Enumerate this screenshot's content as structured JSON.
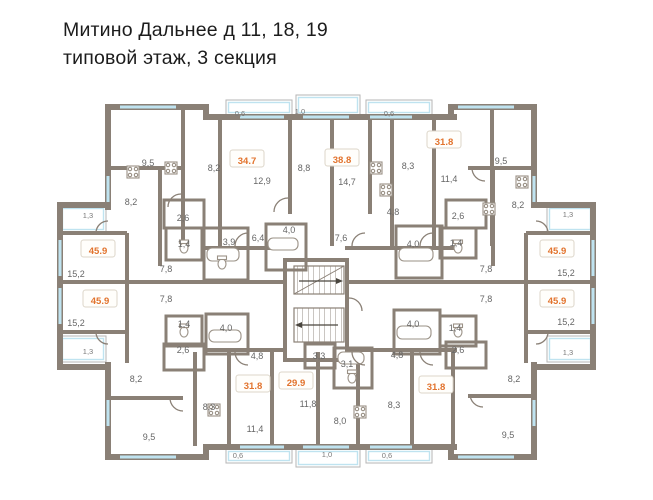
{
  "title": {
    "line1": "Митино Дальнее д 11, 18, 19",
    "line2": "типовой этаж, 3 секция"
  },
  "colors": {
    "wall": "#8a8076",
    "window": "#bfe3f0",
    "accent": "#e2732d",
    "room_label": "#666666",
    "dim_label": "#7a7a7a",
    "title_text": "#1c1c1c"
  },
  "plan": {
    "apartments": [
      {
        "area": "34.7",
        "x": 247,
        "y": 162
      },
      {
        "area": "38.8",
        "x": 342,
        "y": 161
      },
      {
        "area": "31.8",
        "x": 444,
        "y": 143
      },
      {
        "area": "45.9",
        "x": 98,
        "y": 252
      },
      {
        "area": "45.9",
        "x": 100,
        "y": 302
      },
      {
        "area": "45.9",
        "x": 557,
        "y": 252
      },
      {
        "area": "45.9",
        "x": 557,
        "y": 302
      },
      {
        "area": "31.8",
        "x": 253,
        "y": 387
      },
      {
        "area": "29.9",
        "x": 296,
        "y": 384
      },
      {
        "area": "31.8",
        "x": 436,
        "y": 388
      }
    ],
    "rooms": [
      {
        "value": "9,5",
        "x": 148,
        "y": 163
      },
      {
        "value": "8,2",
        "x": 214,
        "y": 168
      },
      {
        "value": "12,9",
        "x": 262,
        "y": 181
      },
      {
        "value": "8,8",
        "x": 304,
        "y": 168
      },
      {
        "value": "14,7",
        "x": 347,
        "y": 182
      },
      {
        "value": "8,3",
        "x": 408,
        "y": 166
      },
      {
        "value": "11,4",
        "x": 449,
        "y": 179
      },
      {
        "value": "9,5",
        "x": 501,
        "y": 161
      },
      {
        "value": "8,2",
        "x": 131,
        "y": 202
      },
      {
        "value": "8,2",
        "x": 518,
        "y": 205
      },
      {
        "value": "2,6",
        "x": 183,
        "y": 218
      },
      {
        "value": "2,6",
        "x": 458,
        "y": 216
      },
      {
        "value": "1,4",
        "x": 184,
        "y": 244
      },
      {
        "value": "3,9",
        "x": 229,
        "y": 242
      },
      {
        "value": "4,0",
        "x": 289,
        "y": 230
      },
      {
        "value": "6,4",
        "x": 258,
        "y": 238
      },
      {
        "value": "7,6",
        "x": 341,
        "y": 238
      },
      {
        "value": "4,8",
        "x": 393,
        "y": 212
      },
      {
        "value": "4,0",
        "x": 413,
        "y": 244
      },
      {
        "value": "1,4",
        "x": 456,
        "y": 243
      },
      {
        "value": "7,8",
        "x": 166,
        "y": 269
      },
      {
        "value": "15,2",
        "x": 76,
        "y": 274
      },
      {
        "value": "7,8",
        "x": 486,
        "y": 269
      },
      {
        "value": "15,2",
        "x": 566,
        "y": 273
      },
      {
        "value": "7,8",
        "x": 166,
        "y": 299
      },
      {
        "value": "15,2",
        "x": 76,
        "y": 323
      },
      {
        "value": "7,8",
        "x": 486,
        "y": 299
      },
      {
        "value": "15,2",
        "x": 566,
        "y": 322
      },
      {
        "value": "1,4",
        "x": 184,
        "y": 324
      },
      {
        "value": "4,0",
        "x": 226,
        "y": 328
      },
      {
        "value": "4,0",
        "x": 413,
        "y": 324
      },
      {
        "value": "1,4",
        "x": 455,
        "y": 328
      },
      {
        "value": "2,6",
        "x": 183,
        "y": 350
      },
      {
        "value": "2,6",
        "x": 458,
        "y": 350
      },
      {
        "value": "4,8",
        "x": 257,
        "y": 356
      },
      {
        "value": "3,3",
        "x": 319,
        "y": 356
      },
      {
        "value": "3,1",
        "x": 347,
        "y": 364
      },
      {
        "value": "4,8",
        "x": 397,
        "y": 355
      },
      {
        "value": "8,2",
        "x": 136,
        "y": 379
      },
      {
        "value": "8,2",
        "x": 514,
        "y": 379
      },
      {
        "value": "8,3",
        "x": 209,
        "y": 407
      },
      {
        "value": "11,8",
        "x": 308,
        "y": 404
      },
      {
        "value": "8,0",
        "x": 340,
        "y": 421
      },
      {
        "value": "8,3",
        "x": 394,
        "y": 405
      },
      {
        "value": "11,4",
        "x": 255,
        "y": 429
      },
      {
        "value": "9,5",
        "x": 149,
        "y": 437
      },
      {
        "value": "9,5",
        "x": 508,
        "y": 435
      }
    ],
    "dimensions": [
      {
        "value": "0,6",
        "x": 240,
        "y": 113
      },
      {
        "value": "1,0",
        "x": 300,
        "y": 111
      },
      {
        "value": "0,6",
        "x": 389,
        "y": 113
      },
      {
        "value": "1,3",
        "x": 88,
        "y": 215
      },
      {
        "value": "1,3",
        "x": 568,
        "y": 214
      },
      {
        "value": "1,3",
        "x": 88,
        "y": 351
      },
      {
        "value": "1,3",
        "x": 568,
        "y": 352
      },
      {
        "value": "0,6",
        "x": 238,
        "y": 455
      },
      {
        "value": "1,0",
        "x": 327,
        "y": 454
      },
      {
        "value": "0,6",
        "x": 387,
        "y": 455
      }
    ]
  }
}
